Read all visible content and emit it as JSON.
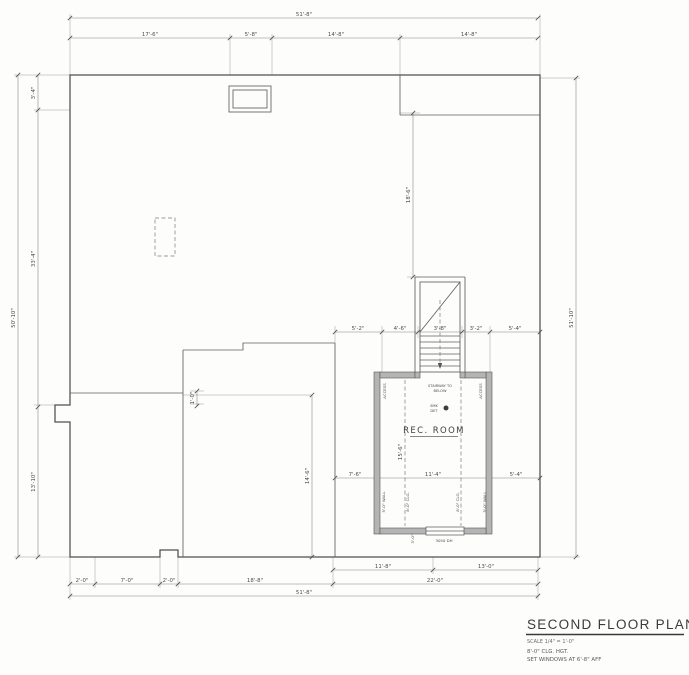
{
  "dims": {
    "top_overall": "51'-8\"",
    "top": [
      "17'-6\"",
      "5'-8\"",
      "14'-8\"",
      "14'-8\""
    ],
    "left_overall": "50'-10\"",
    "left": [
      "3'-4\"",
      "33'-4\"",
      "13'-10\""
    ],
    "right_overall": "51'-10\"",
    "bottom_overall": "51'-8\"",
    "bottom": [
      "2'-0\"",
      "7'-0\"",
      "2'-0\"",
      "18'-8\"",
      "22'-0\""
    ],
    "bottom_right": [
      "11'-8\"",
      "13'-0\""
    ],
    "above_room": [
      "5'-2\"",
      "4'-6\"",
      "3'-8\"",
      "3'-2\"",
      "5'-4\""
    ],
    "room_row": [
      "7'-6\"",
      "11'-4\"",
      "5'-4\""
    ],
    "stair_height": "18'-6\"",
    "interior_left": "14'-6\"",
    "interior_step": "1'-0\"",
    "room_length": "15'-6\"",
    "window_offset": "3'-0\""
  },
  "room": {
    "name": "REC. ROOM",
    "stair_note_line1": "STAIRWAY TO",
    "stair_note_line2": "BELOW",
    "smoke_line1": "SMK",
    "smoke_line2": "DET",
    "access": "ACCESS",
    "wall_note": "5'-0\" WALL",
    "clg_note": "8'-0\" CLG.",
    "window_label": "3050 DH"
  },
  "titleblock": {
    "title": "SECOND FLOOR PLAN",
    "scale": "SCALE 1/4\" = 1'-0\"",
    "note1": "8'-0\" CLG. HGT.",
    "note2": "SET WINDOWS AT 6'-8\" AFF"
  }
}
